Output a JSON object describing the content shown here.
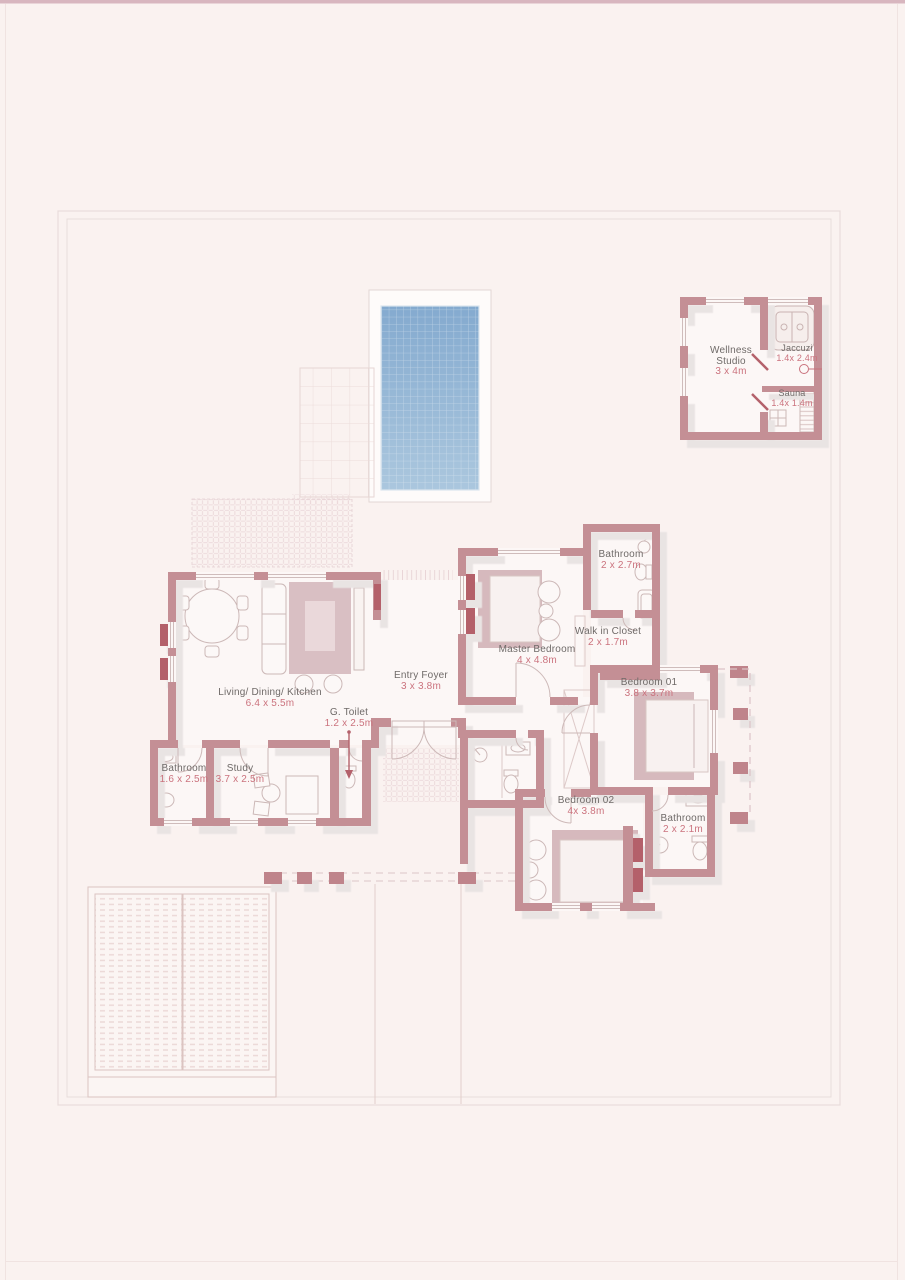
{
  "plan": {
    "type": "villa-ground-floor-plan",
    "colors": {
      "background": "#faf2f0",
      "floor": "#fcf7f6",
      "wall": "#c48f95",
      "wall_dark_sill": "#b4616b",
      "room_name_text": "#6f6a68",
      "dimension_text": "#cb737e",
      "pool_top": "#84aacf",
      "pool_bottom": "#a9c6dd",
      "hatch": "#e8d3d5",
      "shadow": "#e9e4e3"
    },
    "icons": {
      "gtoilet_arrow": "down-arrow-icon",
      "jaccuzi_leader": "leader-circle-icon"
    }
  },
  "rooms": {
    "wellness_studio": {
      "name": "Wellness Studio",
      "dims": "3 x 4m"
    },
    "jaccuzi": {
      "name": "Jaccuzi",
      "dims": "1.4x 2.4m"
    },
    "sauna": {
      "name": "Sauna",
      "dims": "1.4x 1.4m"
    },
    "master_bathroom": {
      "name": "Bathroom",
      "dims": "2 x 2.7m"
    },
    "walk_in_closet": {
      "name": "Walk in Closet",
      "dims": "2 x 1.7m"
    },
    "master_bedroom": {
      "name": "Master Bedroom",
      "dims": "4 x 4.8m"
    },
    "bedroom_01": {
      "name": "Bedroom 01",
      "dims": "3.8 x 3.7m"
    },
    "bedroom_02": {
      "name": "Bedroom 02",
      "dims": "4x 3.8m"
    },
    "bathroom_02": {
      "name": "Bathroom",
      "dims": "2 x 2.1m"
    },
    "living": {
      "name": "Living/ Dining/ Kitchen",
      "dims": "6.4 x 5.5m"
    },
    "entry_foyer": {
      "name": "Entry Foyer",
      "dims": "3 x 3.8m"
    },
    "g_toilet": {
      "name": "G. Toilet",
      "dims": "1.2 x 2.5m"
    },
    "study": {
      "name": "Study",
      "dims": "3.7 x 2.5m"
    },
    "bathroom_study": {
      "name": "Bathroom",
      "dims": "1.6 x 2.5m"
    }
  }
}
